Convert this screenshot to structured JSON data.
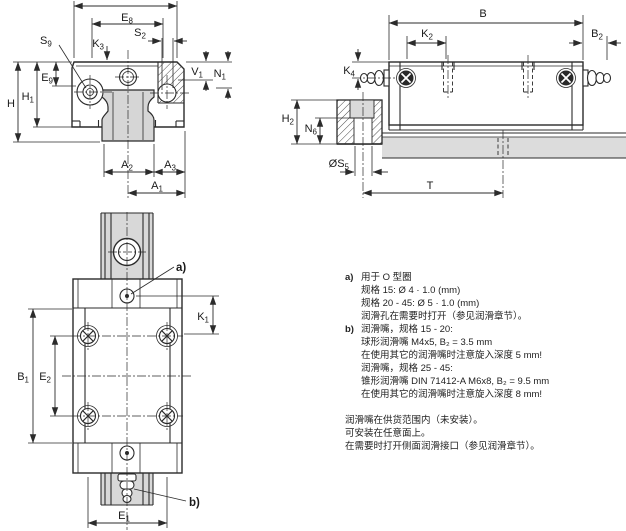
{
  "labels": {
    "e8": {
      "t": "E",
      "s": "8"
    },
    "s9": {
      "t": "S",
      "s": "9"
    },
    "k3": {
      "t": "K",
      "s": "3"
    },
    "s2": {
      "t": "S",
      "s": "2"
    },
    "v1": {
      "t": "V",
      "s": "1"
    },
    "n1": {
      "t": "N",
      "s": "1"
    },
    "e9": {
      "t": "E",
      "s": "9"
    },
    "h": {
      "t": "H",
      "s": ""
    },
    "h1": {
      "t": "H",
      "s": "1"
    },
    "a2": {
      "t": "A",
      "s": "2"
    },
    "a3": {
      "t": "A",
      "s": "3"
    },
    "a1": {
      "t": "A",
      "s": "1"
    },
    "b": {
      "t": "B",
      "s": ""
    },
    "k2": {
      "t": "K",
      "s": "2"
    },
    "b2": {
      "t": "B",
      "s": "2"
    },
    "k4": {
      "t": "K",
      "s": "4"
    },
    "h2": {
      "t": "H",
      "s": "2"
    },
    "n6": {
      "t": "N",
      "s": "6"
    },
    "s5": {
      "t": "ØS",
      "s": "5"
    },
    "t": {
      "t": "T",
      "s": ""
    },
    "k1": {
      "t": "K",
      "s": "1"
    },
    "b1": {
      "t": "B",
      "s": "1"
    },
    "e2": {
      "t": "E",
      "s": "2"
    },
    "e1": {
      "t": "E",
      "s": "1"
    },
    "note_a": "a)",
    "note_b": "b)"
  },
  "notes": {
    "items": [
      {
        "prefix": "a)",
        "text": "用于 O 型圈"
      },
      {
        "prefix": "",
        "text": "规格 15: Ø 4 · 1.0 (mm)"
      },
      {
        "prefix": "",
        "text": "规格 20 - 45: Ø 5 · 1.0 (mm)"
      },
      {
        "prefix": "",
        "text": "润滑孔在需要时打开（参见润滑章节）。"
      },
      {
        "prefix": "b)",
        "text": "润滑嘴，规格 15 - 20:"
      },
      {
        "prefix": "",
        "text": "球形润滑嘴 M4x5, B₂ = 3.5 mm"
      },
      {
        "prefix": "",
        "text": "在使用其它的润滑嘴时注意旋入深度 5 mm!"
      },
      {
        "prefix": "",
        "text": "润滑嘴，规格 25 - 45:"
      },
      {
        "prefix": "",
        "text": "锥形润滑嘴 DIN 71412-A M6x8, B₂ = 9.5 mm"
      },
      {
        "prefix": "",
        "text": "在使用其它的润滑嘴时注意旋入深度 8 mm!"
      },
      {
        "prefix": "",
        "text": "润滑嘴在供货范围内（未安装）。"
      },
      {
        "prefix": "",
        "text": "可安装在任意面上。"
      },
      {
        "prefix": "",
        "text": "在需要时打开侧面润滑接口（参见润滑章节）。"
      }
    ]
  },
  "colors": {
    "line": "#2b2b2b",
    "rail_gray": "#d6d6d6",
    "light_gray": "#dadada"
  }
}
